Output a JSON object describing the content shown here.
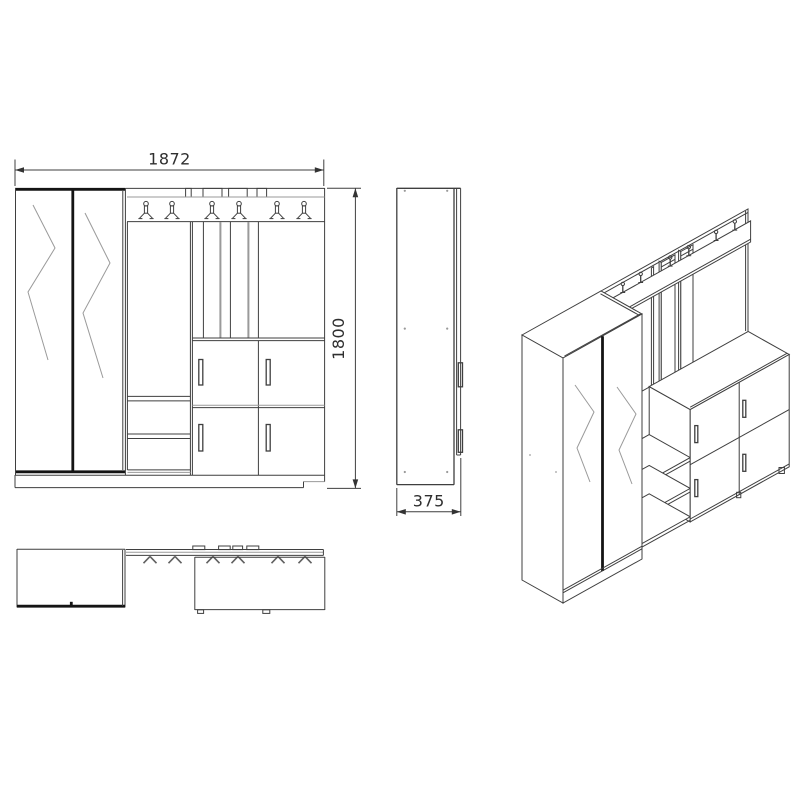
{
  "drawing": {
    "kind": "furniture-technical-drawing",
    "colors": {
      "background": "#ffffff",
      "line": "#3f3f3f",
      "line_thick": "#141414",
      "line_light": "#9a9a9a",
      "text": "#2f2f2f"
    },
    "views": {
      "front": {
        "width_label": "1872",
        "height_label": "1800",
        "hook_count": 6,
        "door_count": 4
      },
      "side": {
        "depth_label": "375"
      },
      "top": {
        "hook_count": 6
      },
      "isometric": {
        "hook_count": 6
      }
    }
  }
}
